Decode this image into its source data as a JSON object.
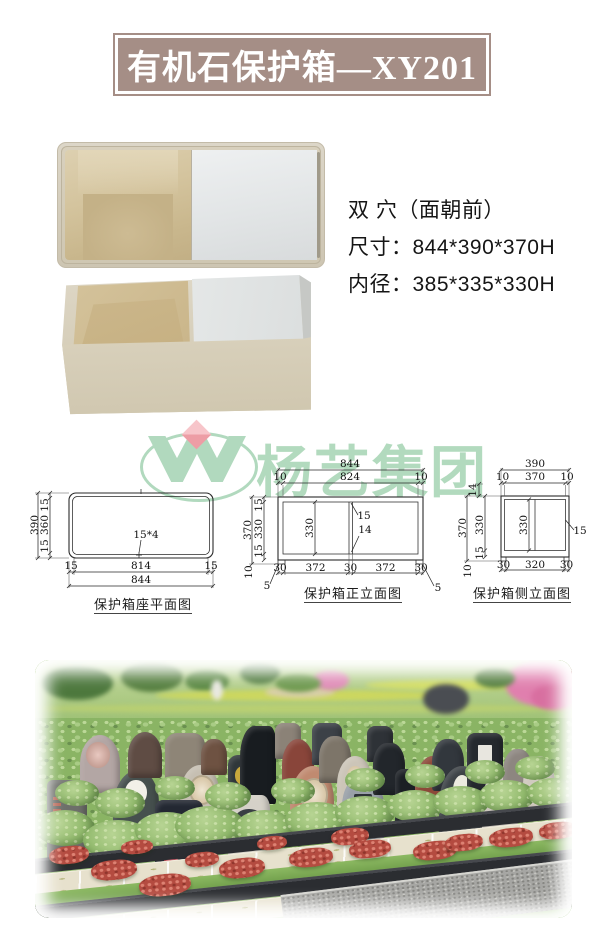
{
  "banner": {
    "title": "有机石保护箱—XY201"
  },
  "specs": {
    "cavity": "双 穴（面朝前）",
    "size": "尺寸：844*390*370H",
    "inner": "内径：385*335*330H"
  },
  "watermark": {
    "company": "杨艺集团"
  },
  "drawings": {
    "plan": {
      "caption": "保护箱座平面图",
      "v_total": "390",
      "v": [
        "15",
        "360",
        "15"
      ],
      "h_inner": [
        "15",
        "814",
        "15"
      ],
      "h_total": "844",
      "note": "15*4"
    },
    "front": {
      "caption": "保护箱正立面图",
      "top_total": "844",
      "top": [
        "10",
        "824",
        "10"
      ],
      "v_total": "370",
      "v": [
        "15",
        "330",
        "15"
      ],
      "base": "10",
      "foot": "5",
      "cavity_h": "330",
      "div_top": "15",
      "div_bot": "14",
      "bottom": [
        "30",
        "372",
        "30",
        "372",
        "30"
      ]
    },
    "side": {
      "caption": "保护箱侧立面图",
      "top_total": "390",
      "top": [
        "10",
        "370",
        "10"
      ],
      "lid": "14",
      "v_total": "370",
      "v": [
        "330",
        "15"
      ],
      "base": "10",
      "cavity_h": "330",
      "wall": "15",
      "bottom": [
        "30",
        "320",
        "30"
      ]
    }
  },
  "colors": {
    "banner_bg": "#a58e86",
    "banner_text": "#ffffff",
    "watermark_green": "#a0d2ae",
    "watermark_pink": "#ef9aa4",
    "box_beige": "#d8d1bf",
    "box_interior_tan": "#c9b78d",
    "lid_white": "#e9ebec",
    "drawing_line": "#2a2a2a",
    "lawn_green": "#7fae57",
    "bush_green": "#8ab464",
    "granite_dark": "#2b2d31",
    "flower_red": "#b44b40",
    "paving_cream": "#e7e1cd"
  },
  "cemetery": {
    "garden": [
      [
        6,
        6,
        72,
        34,
        "#4d783d"
      ],
      [
        86,
        2,
        62,
        30,
        "#567f40"
      ],
      [
        150,
        10,
        44,
        22,
        "#5d8a46"
      ],
      [
        205,
        2,
        40,
        22,
        "#4f7a3e"
      ],
      [
        120,
        30,
        300,
        11,
        "#ccd75f"
      ],
      [
        330,
        20,
        180,
        10,
        "#d2dd66"
      ],
      [
        0,
        44,
        537,
        9,
        "#b9cf72"
      ],
      [
        230,
        26,
        70,
        12,
        "#d8cfa8"
      ],
      [
        278,
        10,
        36,
        20,
        "#df8cb7"
      ],
      [
        470,
        0,
        74,
        46,
        "#e07fae"
      ],
      [
        496,
        24,
        48,
        26,
        "#d86fa0"
      ],
      [
        388,
        24,
        46,
        30,
        "#4a4d52"
      ],
      [
        176,
        20,
        12,
        20,
        "#e8e8e0"
      ],
      [
        240,
        14,
        46,
        18,
        "#6f9a50"
      ],
      [
        440,
        8,
        40,
        20,
        "#547e40"
      ]
    ],
    "headstones": [
      [
        12,
        120,
        40,
        85,
        "#6d6f6a",
        "6px 6px 2px 2px",
        "text"
      ],
      [
        45,
        75,
        40,
        58,
        "#b3a6a4",
        "50% 50% 8% 8%",
        "flower"
      ],
      [
        78,
        110,
        46,
        72,
        "#46504e",
        "54% 46% 6% 6%",
        "hole"
      ],
      [
        93,
        72,
        34,
        46,
        "#5f4c44",
        "50% 50% 8% 8%",
        ""
      ],
      [
        130,
        73,
        40,
        50,
        "#8e8577",
        "12px 12px 2px 2px",
        ""
      ],
      [
        145,
        105,
        40,
        62,
        "#c6bfb2",
        "50% 50% 8% 8%",
        "oval"
      ],
      [
        120,
        140,
        48,
        78,
        "#232832",
        "8px 8px 2px 2px",
        "lotus"
      ],
      [
        166,
        79,
        26,
        36,
        "#6e5242",
        "45% 45% 8% 8%",
        ""
      ],
      [
        193,
        95,
        36,
        62,
        "#30373a",
        "10px 45% 4% 4%",
        "yellow"
      ],
      [
        205,
        66,
        36,
        78,
        "#181c20",
        "40% 20% 4% 4%",
        ""
      ],
      [
        193,
        135,
        42,
        68,
        "#d5d1c8",
        "50% 20% 6% 6%",
        "fan"
      ],
      [
        240,
        63,
        26,
        36,
        "#8b8277",
        "8px 8px 2px 2px",
        ""
      ],
      [
        247,
        79,
        32,
        52,
        "#89453a",
        "50% 50% 8% 8%",
        ""
      ],
      [
        255,
        106,
        44,
        72,
        "#c08a70",
        "52% 48% 6% 6%",
        "oval"
      ],
      [
        277,
        63,
        30,
        42,
        "#3c4147",
        "8px 8px 2px 2px",
        ""
      ],
      [
        284,
        76,
        32,
        47,
        "#7d7569",
        "45% 45% 6% 6%",
        ""
      ],
      [
        302,
        96,
        36,
        57,
        "#ccc5b8",
        "50% 50% 8% 8%",
        "oval2"
      ],
      [
        307,
        116,
        42,
        66,
        "#99a0a8",
        "46% 46% 8% 8%",
        "badge"
      ],
      [
        332,
        66,
        26,
        36,
        "#2e3237",
        "8px 8px 2px 2px",
        ""
      ],
      [
        338,
        83,
        32,
        52,
        "#22262b",
        "42% 42% 6% 6%",
        ""
      ],
      [
        360,
        109,
        32,
        57,
        "#1b1f24",
        "8px 8px 2px 2px",
        ""
      ],
      [
        380,
        96,
        32,
        57,
        "#8c4939",
        "55% 45% 8% 8%",
        ""
      ],
      [
        397,
        79,
        32,
        52,
        "#32373d",
        "45% 45% 8% 8%",
        ""
      ],
      [
        404,
        106,
        46,
        77,
        "#3e4347",
        "50% 50% 6% 6%",
        "hole2"
      ],
      [
        432,
        73,
        36,
        62,
        "#25292e",
        "8px 8px 2px 2px",
        "paper"
      ],
      [
        447,
        109,
        36,
        66,
        "#ccc6bd",
        "55% 45% 8% 8%",
        ""
      ],
      [
        468,
        89,
        30,
        50,
        "#8d8680",
        "45% 45% 8% 8%",
        ""
      ],
      [
        488,
        96,
        32,
        57,
        "#d1cbc0",
        "50% 50% 8% 8%",
        ""
      ]
    ],
    "bushes": [
      [
        0,
        150,
        60,
        36
      ],
      [
        48,
        160,
        70,
        40
      ],
      [
        100,
        152,
        64,
        38
      ],
      [
        60,
        128,
        50,
        30
      ],
      [
        140,
        146,
        70,
        40
      ],
      [
        200,
        150,
        60,
        36
      ],
      [
        170,
        122,
        46,
        28
      ],
      [
        250,
        142,
        64,
        36
      ],
      [
        300,
        136,
        60,
        34
      ],
      [
        352,
        130,
        56,
        32
      ],
      [
        398,
        126,
        56,
        32
      ],
      [
        444,
        120,
        56,
        32
      ],
      [
        492,
        118,
        52,
        30
      ],
      [
        236,
        118,
        44,
        26
      ],
      [
        310,
        108,
        40,
        24
      ],
      [
        370,
        104,
        40,
        24
      ],
      [
        430,
        100,
        40,
        24
      ],
      [
        480,
        96,
        40,
        24
      ],
      [
        20,
        120,
        44,
        26
      ],
      [
        120,
        116,
        40,
        24
      ]
    ],
    "flowers": [
      [
        14,
        186,
        40,
        18
      ],
      [
        56,
        200,
        46,
        20
      ],
      [
        104,
        214,
        52,
        22
      ],
      [
        150,
        192,
        34,
        15
      ],
      [
        184,
        198,
        46,
        20
      ],
      [
        254,
        188,
        44,
        19
      ],
      [
        296,
        168,
        38,
        17
      ],
      [
        314,
        180,
        42,
        18
      ],
      [
        378,
        181,
        44,
        19
      ],
      [
        410,
        174,
        38,
        17
      ],
      [
        454,
        168,
        44,
        19
      ],
      [
        504,
        162,
        38,
        17
      ],
      [
        86,
        180,
        32,
        14
      ],
      [
        222,
        176,
        30,
        14
      ]
    ]
  }
}
